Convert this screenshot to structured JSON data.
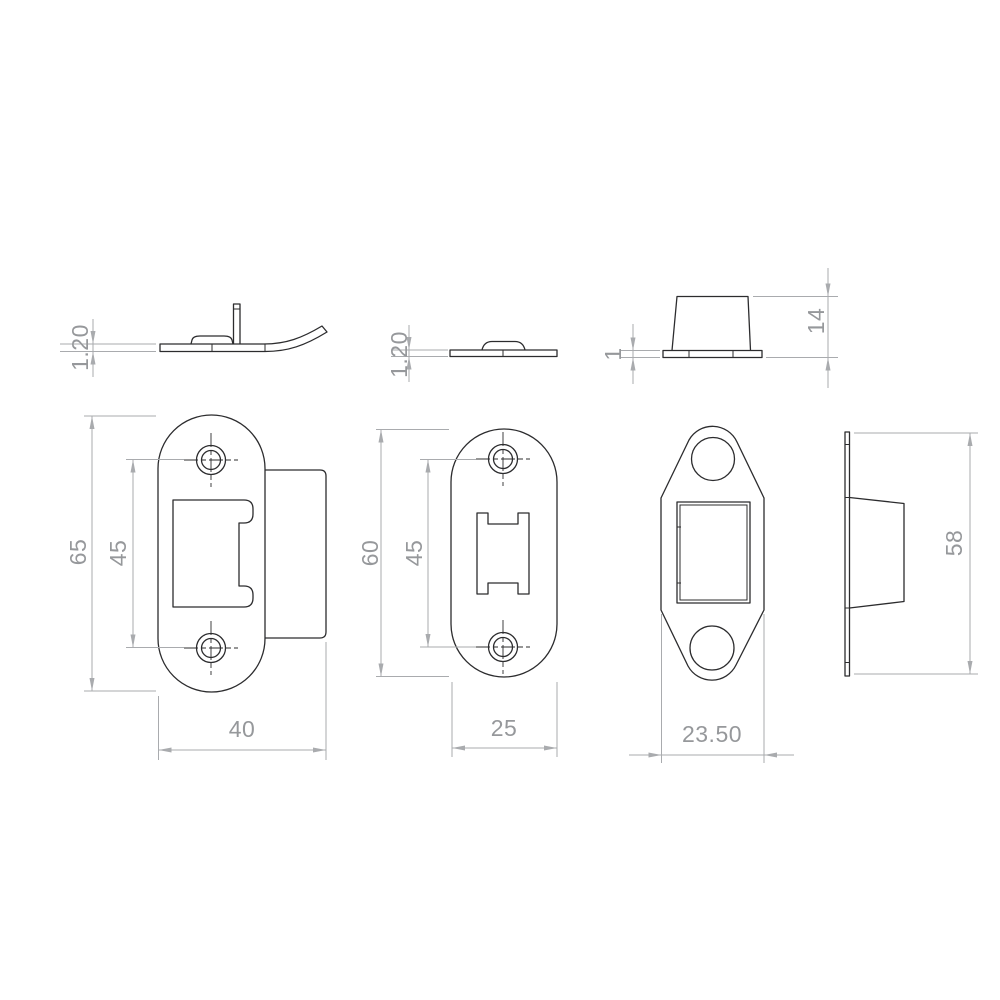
{
  "document": {
    "type": "technical-drawing",
    "subject": "door strike plates and keep - orthographic views with dimensions",
    "colors": {
      "outline": "#2c2c2e",
      "dimension": "#a9abae",
      "dimension_text": "#96989b",
      "background": "#ffffff"
    }
  },
  "views": {
    "lip_strike_side": {
      "label": "radius lip strike plate - side view",
      "dims": {
        "thickness": "1.20"
      }
    },
    "flat_strike_side": {
      "label": "flat strike plate - side view",
      "dims": {
        "thickness": "1.20"
      }
    },
    "box_keep_side": {
      "label": "box keep - side view",
      "dims": {
        "flange_thickness": "1",
        "height": "14"
      }
    },
    "lip_strike_front": {
      "label": "radius lip strike plate - front view",
      "dims": {
        "height": "65",
        "hole_pitch": "45",
        "width": "40"
      }
    },
    "flat_strike_front": {
      "label": "flat strike plate - front view",
      "dims": {
        "height": "60",
        "hole_pitch": "45",
        "width": "25"
      }
    },
    "box_keep_front": {
      "label": "box keep - front view",
      "dims": {
        "width": "23.50"
      }
    },
    "box_keep_profile": {
      "label": "box keep - profile view",
      "dims": {
        "height": "58"
      }
    }
  }
}
